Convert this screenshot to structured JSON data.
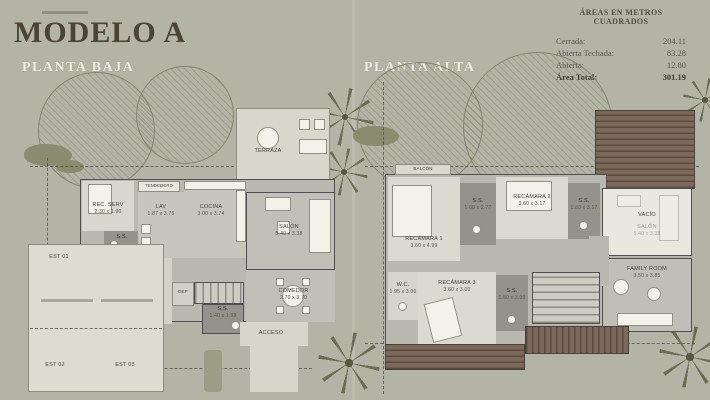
{
  "header": {
    "title": "MODELO A"
  },
  "area_table": {
    "title": "ÁREAS EN METROS CUADRADOS",
    "rows": [
      {
        "label": "Cerrada:",
        "value": "204.11"
      },
      {
        "label": "Abierta Techada:",
        "value": "83.28"
      },
      {
        "label": "Abierta:",
        "value": "12.80"
      },
      {
        "label": "Área Total:",
        "value": "301.19"
      }
    ]
  },
  "plans": {
    "baja": {
      "label": "PLANTA BAJA",
      "rooms": {
        "terraza": {
          "name": "TERRAZA"
        },
        "tendedero": {
          "name": "TENDEDERO"
        },
        "rec_serv": {
          "name": "REC. SERV",
          "dims": "2.30 x 1.90"
        },
        "lav": {
          "name": "LAV",
          "dims": "1.87 x 3.76"
        },
        "cocina": {
          "name": "COCINA",
          "dims": "3.00 x 3.74"
        },
        "salon": {
          "name": "SALÓN",
          "dims": "5.40 x 3.38"
        },
        "comedor": {
          "name": "COMEDOR",
          "dims": "2.70 x 3.70"
        },
        "ss1": {
          "name": "S.S."
        },
        "ss2": {
          "name": "S.S.",
          "dims": "1.40 x 1.98"
        },
        "dep": {
          "name": "DEP"
        },
        "acceso": {
          "name": "ACCESO"
        },
        "acceso_servicio": {
          "name": "ACCESO DE SERVICIO"
        },
        "est01": {
          "name": "EST 01"
        },
        "est02": {
          "name": "EST 02"
        },
        "est03": {
          "name": "EST 03"
        }
      }
    },
    "alta": {
      "label": "PLANTA ALTA",
      "rooms": {
        "balcon": {
          "name": "BALCÓN"
        },
        "rec1": {
          "name": "RECÁMARA 1",
          "dims": "3.60 x 4.99"
        },
        "ss1": {
          "name": "S.S.",
          "dims": "1.60 x 2.77"
        },
        "rec2": {
          "name": "RECÁMARA 2",
          "dims": "3.60 x 3.17"
        },
        "ss2": {
          "name": "S.S.",
          "dims": "1.60 x 3.17"
        },
        "vacio": {
          "name": "VACÍO"
        },
        "vacio_sub": {
          "name": "SALÓN",
          "dims": "5.40 x 3.38"
        },
        "family": {
          "name": "FAMILY ROOM",
          "dims": "3.50 x 3.85"
        },
        "wc": {
          "name": "W.C.",
          "dims": "1.95 x 3.00"
        },
        "rec3": {
          "name": "RECÁMARA 3",
          "dims": "3.60 x 3.00"
        },
        "ss3": {
          "name": "S.S.",
          "dims": "1.60 x 3.00"
        }
      }
    }
  },
  "colors": {
    "background": "#b3b4a6",
    "title": "#4a4336",
    "subtitle": "#f0eee3",
    "wall": "#4f4e55",
    "roof": "#7c695b"
  }
}
